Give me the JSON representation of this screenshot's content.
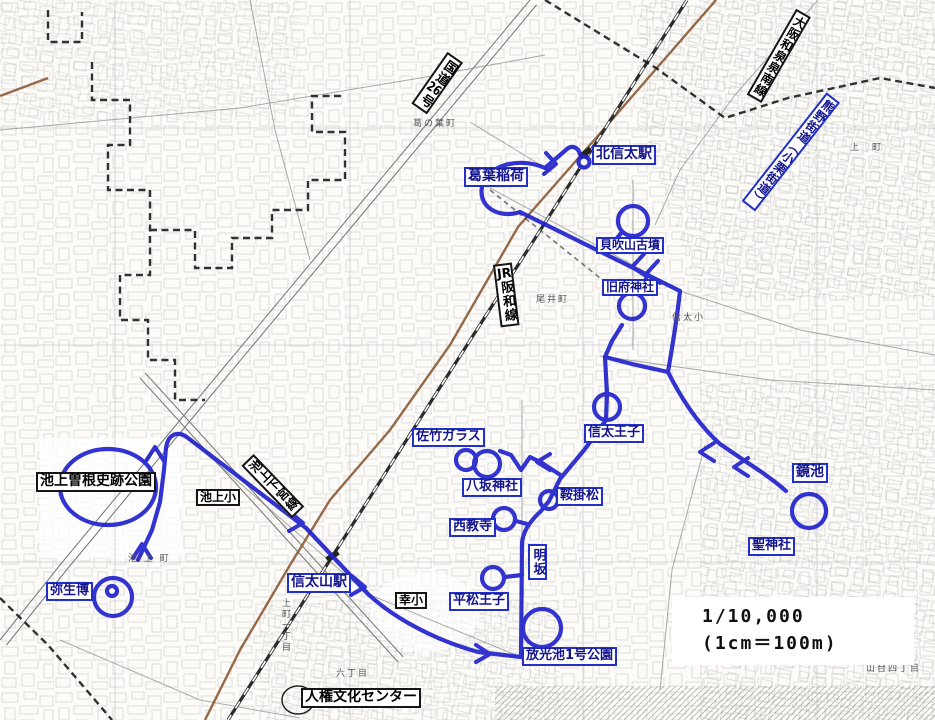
{
  "scale": {
    "line1": "1/10,000",
    "line2": "(1cm＝100m)"
  },
  "colors": {
    "route_blue": "#2424cd",
    "road_brown": "#8a5a35",
    "boundary_black": "#1c1c1c"
  },
  "labels": [
    {
      "id": "kitashinoda-station",
      "text": "北信太駅",
      "style": "blue",
      "x": 592,
      "y": 145,
      "fs": 14
    },
    {
      "id": "kuzunoha-inari",
      "text": "葛葉稲荷",
      "style": "blue",
      "x": 464,
      "y": 167,
      "fs": 14
    },
    {
      "id": "kaibukiyama-kofun",
      "text": "貝吹山古墳",
      "style": "blue",
      "x": 596,
      "y": 237,
      "fs": 12
    },
    {
      "id": "kyufu-jinja",
      "text": "旧府神社",
      "style": "blue",
      "x": 602,
      "y": 279,
      "fs": 12
    },
    {
      "id": "shinoda-oji",
      "text": "信太王子",
      "style": "blue",
      "x": 584,
      "y": 424,
      "fs": 13
    },
    {
      "id": "satake-glass",
      "text": "佐竹ガラス",
      "style": "blue",
      "x": 412,
      "y": 428,
      "fs": 13
    },
    {
      "id": "yasaka-jinja",
      "text": "八坂神社",
      "style": "blue",
      "x": 462,
      "y": 478,
      "fs": 13
    },
    {
      "id": "saikyoji",
      "text": "西教寺",
      "style": "blue",
      "x": 449,
      "y": 518,
      "fs": 13
    },
    {
      "id": "kurakake-matsu",
      "text": "鞍掛松",
      "style": "blue",
      "x": 556,
      "y": 487,
      "fs": 13
    },
    {
      "id": "kagami-ike",
      "text": "鏡池",
      "style": "blue",
      "x": 792,
      "y": 463,
      "fs": 14
    },
    {
      "id": "hijiri-jinja",
      "text": "聖神社",
      "style": "blue",
      "x": 748,
      "y": 537,
      "fs": 13
    },
    {
      "id": "akesaka",
      "text": "明坂",
      "style": "blue",
      "x": 528,
      "y": 544,
      "fs": 13,
      "vertical": true
    },
    {
      "id": "hiramatsu-oji",
      "text": "平松王子",
      "style": "blue",
      "x": 449,
      "y": 592,
      "fs": 13
    },
    {
      "id": "hokoike-park",
      "text": "放光池1号公園",
      "style": "blue",
      "x": 522,
      "y": 647,
      "fs": 13
    },
    {
      "id": "yayoi-haku",
      "text": "弥生博",
      "style": "blue",
      "x": 46,
      "y": 582,
      "fs": 13
    },
    {
      "id": "shinodayama-station",
      "text": "信太山駅",
      "style": "blue",
      "x": 287,
      "y": 573,
      "fs": 14
    },
    {
      "id": "ikegami-sone-park",
      "text": "池上曽根史跡公園",
      "style": "black",
      "x": 36,
      "y": 472,
      "fs": 14
    },
    {
      "id": "ikegami-elementary",
      "text": "池上小",
      "style": "black",
      "x": 196,
      "y": 489,
      "fs": 12
    },
    {
      "id": "saiwai-elementary",
      "text": "幸小",
      "style": "black",
      "x": 395,
      "y": 592,
      "fs": 12
    },
    {
      "id": "jinken-bunka-center",
      "text": "人権文化センター",
      "style": "black",
      "x": 301,
      "y": 688,
      "fs": 14
    },
    {
      "id": "kokudo-26",
      "text": "国道26号",
      "style": "black",
      "cx": 437,
      "cy": 83,
      "rot": 35,
      "fs": 13,
      "vertical": true
    },
    {
      "id": "osaka-izumi-sennan-line",
      "text": "大阪和泉泉南線",
      "style": "black",
      "cx": 779,
      "cy": 56,
      "rot": 30,
      "fs": 12,
      "vertical": true
    },
    {
      "id": "kumano-kaido",
      "text": "熊野街道（小栗街道）",
      "style": "blue",
      "cx": 791,
      "cy": 152,
      "rot": 38,
      "fs": 12,
      "vertical": true
    },
    {
      "id": "ikegami-shimomiya-line",
      "text": "池上下宮線",
      "style": "black",
      "cx": 273,
      "cy": 486,
      "rot": -44,
      "fs": 12,
      "vertical": true
    },
    {
      "id": "jr-hanwa-line",
      "text": "JR阪和線",
      "style": "black",
      "cx": 506,
      "cy": 295,
      "rot": -7,
      "fs": 13,
      "vertical": true
    }
  ],
  "area_texts": [
    {
      "id": "oicho",
      "text": "尾井町",
      "x": 536,
      "y": 292
    },
    {
      "id": "uemachi",
      "text": "上　町",
      "x": 850,
      "y": 140
    },
    {
      "id": "ikegamicho",
      "text": "池 上 町",
      "x": 128,
      "y": 551
    },
    {
      "id": "kuzunohacho",
      "text": "葛の葉町",
      "x": 413,
      "y": 116
    },
    {
      "id": "shinoda-sho",
      "text": "信太小",
      "x": 672,
      "y": 310
    },
    {
      "id": "yamadai-4chome",
      "text": "山台四丁目",
      "x": 866,
      "y": 661
    },
    {
      "id": "rokuchome",
      "text": "六丁目",
      "x": 336,
      "y": 666
    },
    {
      "id": "uemachi-1chome",
      "text": "上町一丁目",
      "x": 279,
      "y": 598,
      "vertical": true
    }
  ]
}
